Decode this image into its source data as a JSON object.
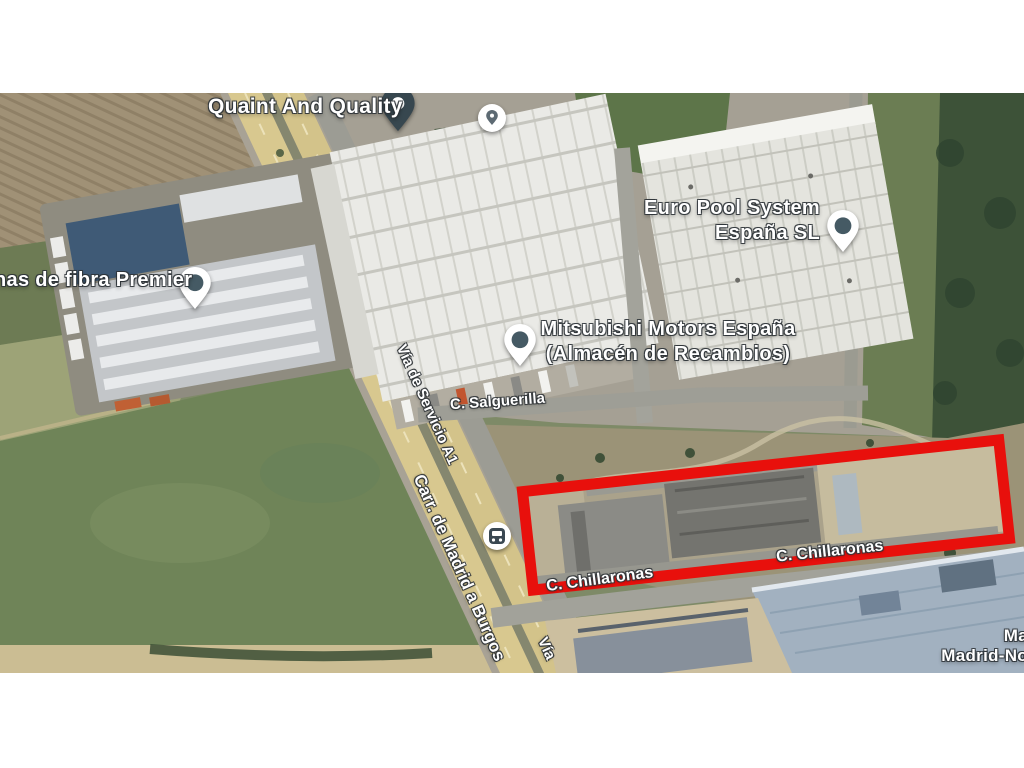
{
  "map_type": "satellite",
  "labels": {
    "quaint": "Quaint And Quality",
    "fibra": "nas de fibra Premier",
    "europool_line1": "Euro Pool System",
    "europool_line2": "España SL",
    "mitsubishi_line1": "Mitsubishi Motors España",
    "mitsubishi_line2": "(Almacén de Recambios)",
    "makro_line1": "Ma",
    "makro_line2": "Madrid-No",
    "salguerilla": "C. Salguerilla",
    "chillaronas_left": "C. Chillaronas",
    "chillaronas_right": "C. Chillaronas",
    "via_servicio": "Vía de Servicio A1",
    "carr_madrid": "Carr. de Madrid a Burgos",
    "via_partial": "Vía"
  },
  "pins": [
    {
      "id": "quaint-marker",
      "type": "selected-place-marker"
    },
    {
      "id": "quaint-poi-badge",
      "type": "poi-badge"
    },
    {
      "id": "fibra-pin",
      "type": "place-pin"
    },
    {
      "id": "europool-pin",
      "type": "place-pin"
    },
    {
      "id": "mitsubishi-pin",
      "type": "place-pin"
    },
    {
      "id": "bus-stop",
      "type": "bus-stop-badge"
    }
  ],
  "annotation": {
    "shape": "rectangle",
    "border_color": "#e8100c"
  },
  "colors": {
    "pin_body": "#ffffff",
    "pin_dot": "#455a64",
    "selected_marker_body": "#37474f",
    "highway_tan": "#d8c88f",
    "label_text": "#ffffff",
    "forest_green": "#3d5238"
  }
}
